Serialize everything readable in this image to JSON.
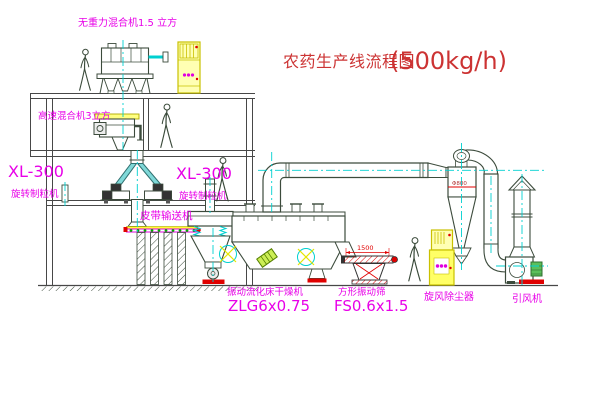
{
  "diagram": {
    "title": {
      "name": "农药生产线流程图",
      "capacity": "(500kg/h)"
    },
    "labels": {
      "gravity_free_mixer": "无重力混合机1.5 立方",
      "high_speed_mixer": "高速混合机3立方",
      "mill_left": {
        "model": "XL-300",
        "name": "旋转制粒机"
      },
      "mill_mid": {
        "model": "XL-300",
        "name": "旋转制粒机"
      },
      "belt_conveyor": "皮带输送机",
      "dryer": {
        "name": "振动流化床干燥机",
        "model": "ZLG6x0.75"
      },
      "sieve": {
        "name": "方形振动筛",
        "model": "FS0.6x1.5"
      },
      "cyclone": "旋风除尘器",
      "fan": "引风机"
    },
    "dimensions": {
      "sieve_length": "1500",
      "cyclone_diameter": "Φ800"
    },
    "colors": {
      "label_magenta": "#e800e8",
      "title_red": "#cc3333",
      "line_dark": "#3c4b3c",
      "centerline_cyan": "#00d0d0",
      "cabinet_yellow": "#ffff66",
      "accent_red": "#e00000",
      "roller_green": "#00aa00"
    }
  }
}
